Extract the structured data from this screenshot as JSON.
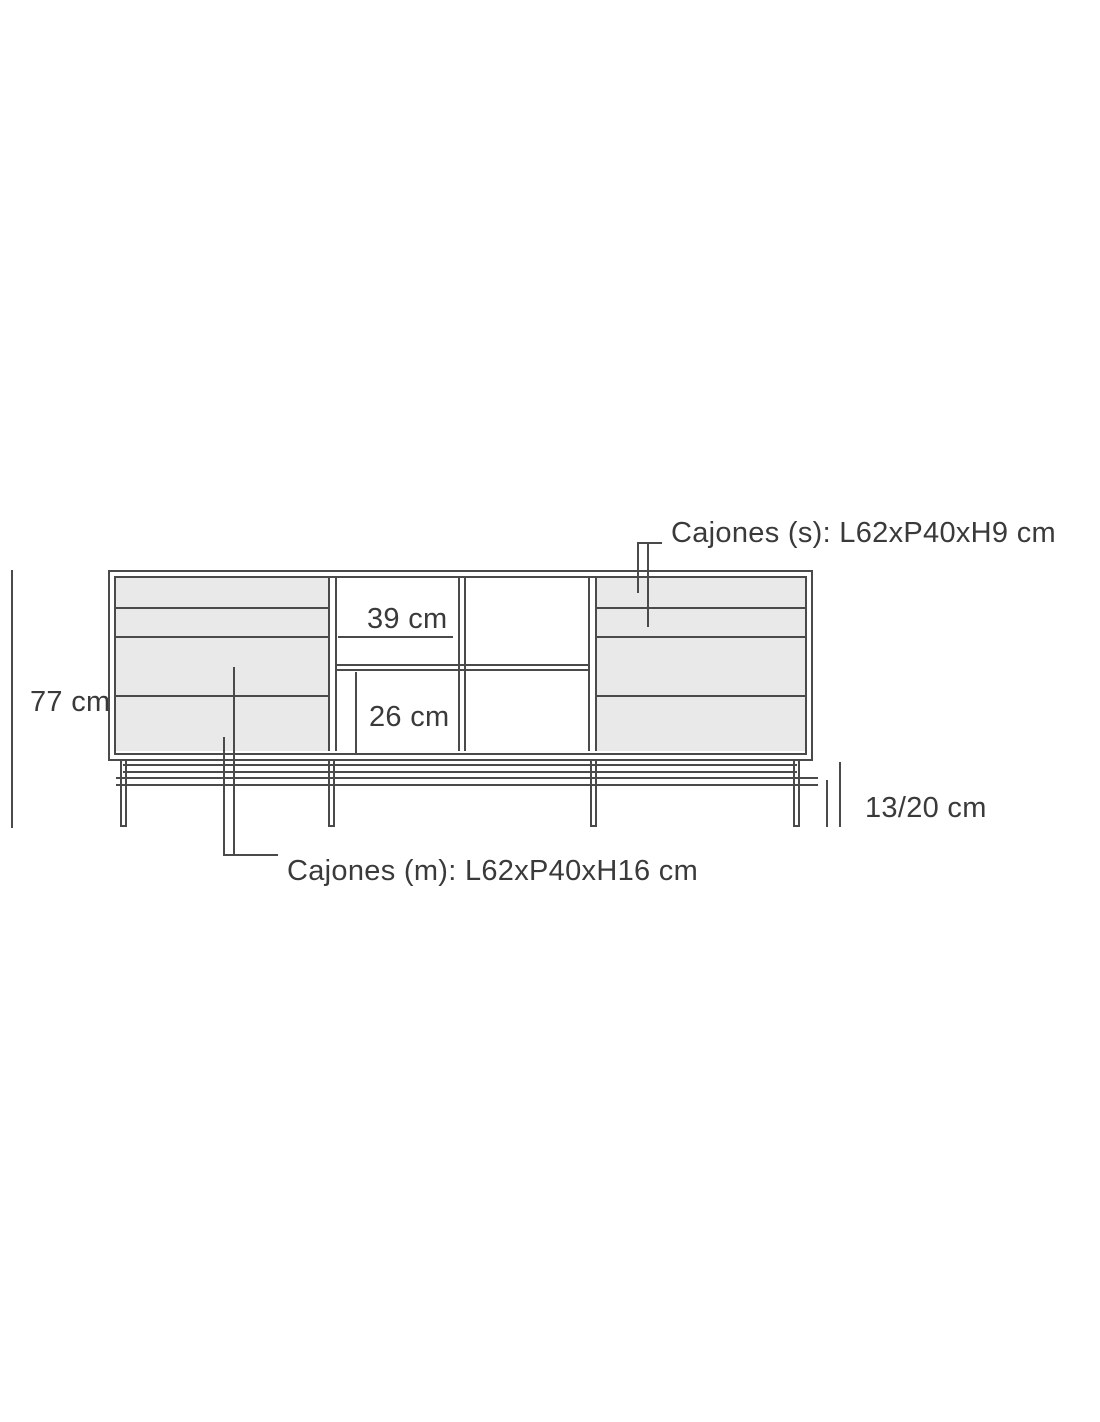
{
  "diagram": {
    "type": "furniture-dimension-drawing",
    "labels": {
      "total_height": "77 cm",
      "shelf_width": "39 cm",
      "shelf_height": "26 cm",
      "leg_height": "13/20 cm",
      "small_drawers": "Cajones (s): L62xP40xH9 cm",
      "medium_drawers": "Cajones (m): L62xP40xH16 cm"
    },
    "colors": {
      "line": "#4a4a4a",
      "text": "#3a3a3a",
      "drawer_fill": "#e9e9e9",
      "background": "#ffffff"
    }
  }
}
